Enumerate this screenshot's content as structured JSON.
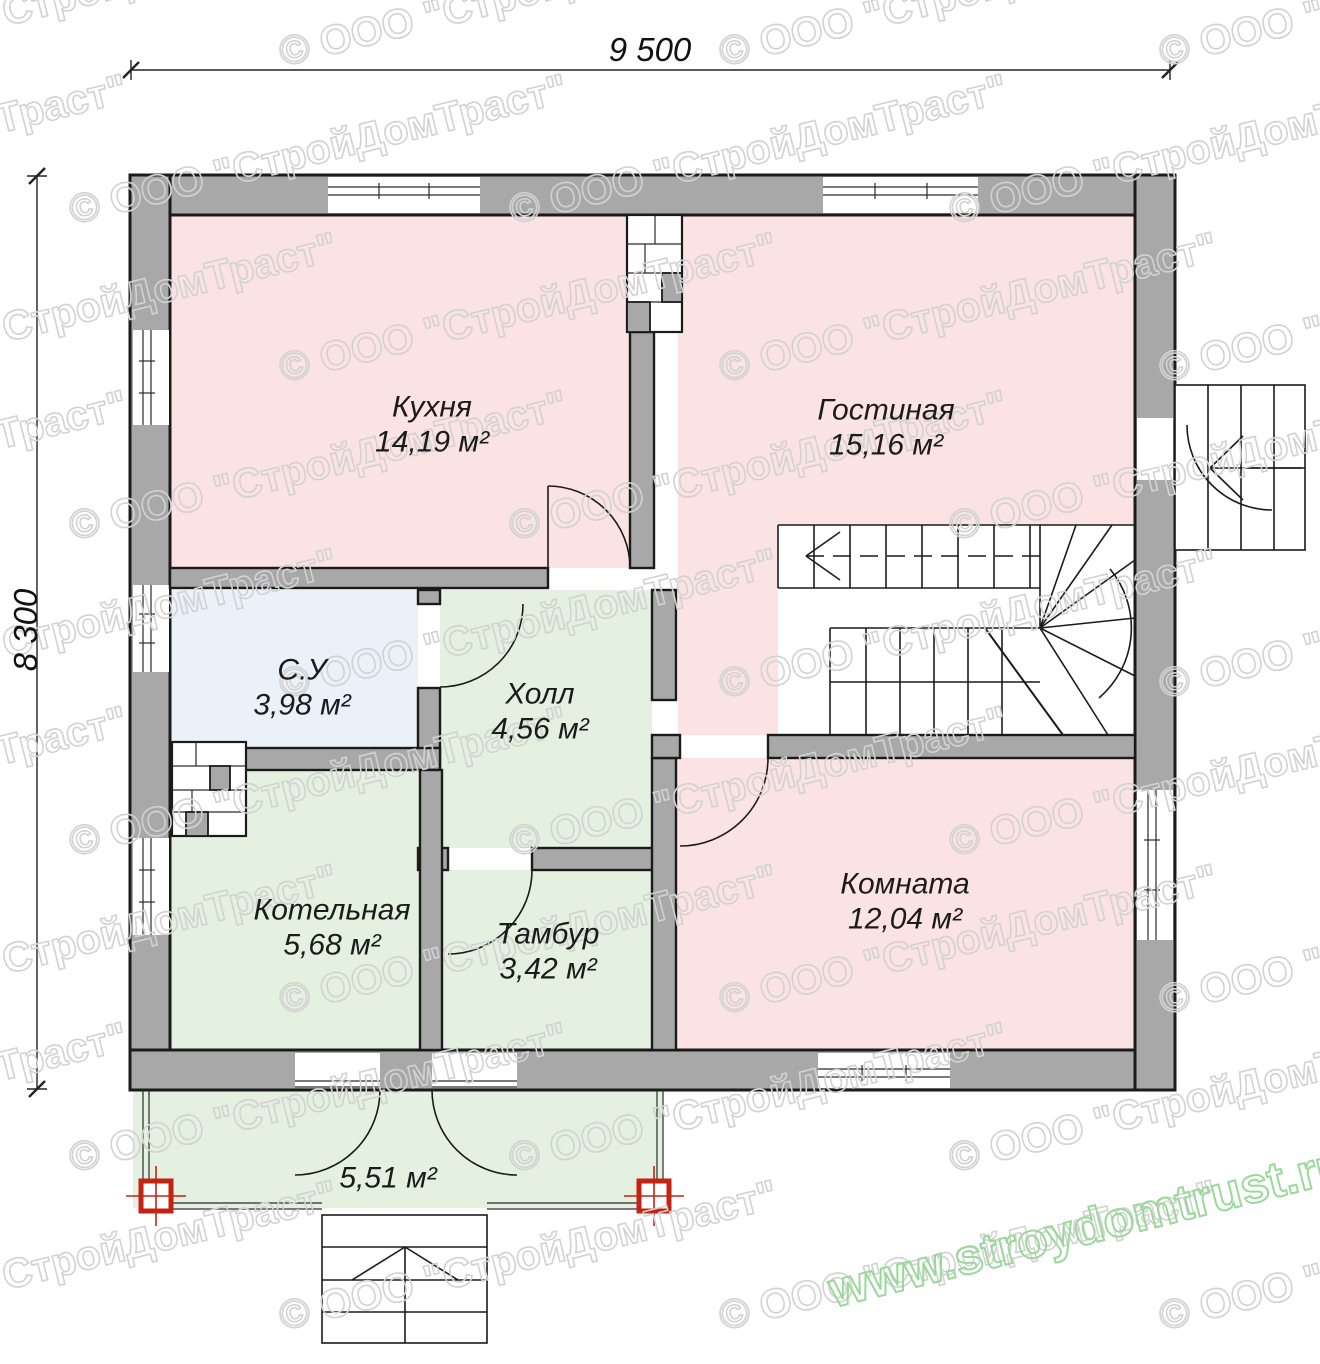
{
  "plan": {
    "dimension_top": "9 500",
    "dimension_left": "8 300",
    "rooms": [
      {
        "name": "Кухня",
        "area": "14,19 м²"
      },
      {
        "name": "Гостиная",
        "area": "15,16 м²"
      },
      {
        "name": "С.У",
        "area": "3,98 м²"
      },
      {
        "name": "Холл",
        "area": "4,56 м²"
      },
      {
        "name": "Котельная",
        "area": "5,68 м²"
      },
      {
        "name": "Тамбур",
        "area": "3,42 м²"
      },
      {
        "name": "Комната",
        "area": "12,04 м²"
      },
      {
        "name": "",
        "area": "5,51 м²"
      }
    ],
    "colors": {
      "wall": "#a8a8a8",
      "outline": "#1b1b1b",
      "room_pink": "#fbe3e4",
      "room_green": "#e4f1e1",
      "room_blue": "#eaf1f8",
      "column_red": "#c42313",
      "watermark_gray": "#d2d2d2",
      "watermark_green": "#9bd89b"
    },
    "watermarks": {
      "company": "© ООО \"СтройДомТраст\"",
      "website": "www.stroydomtrust.ru"
    }
  }
}
